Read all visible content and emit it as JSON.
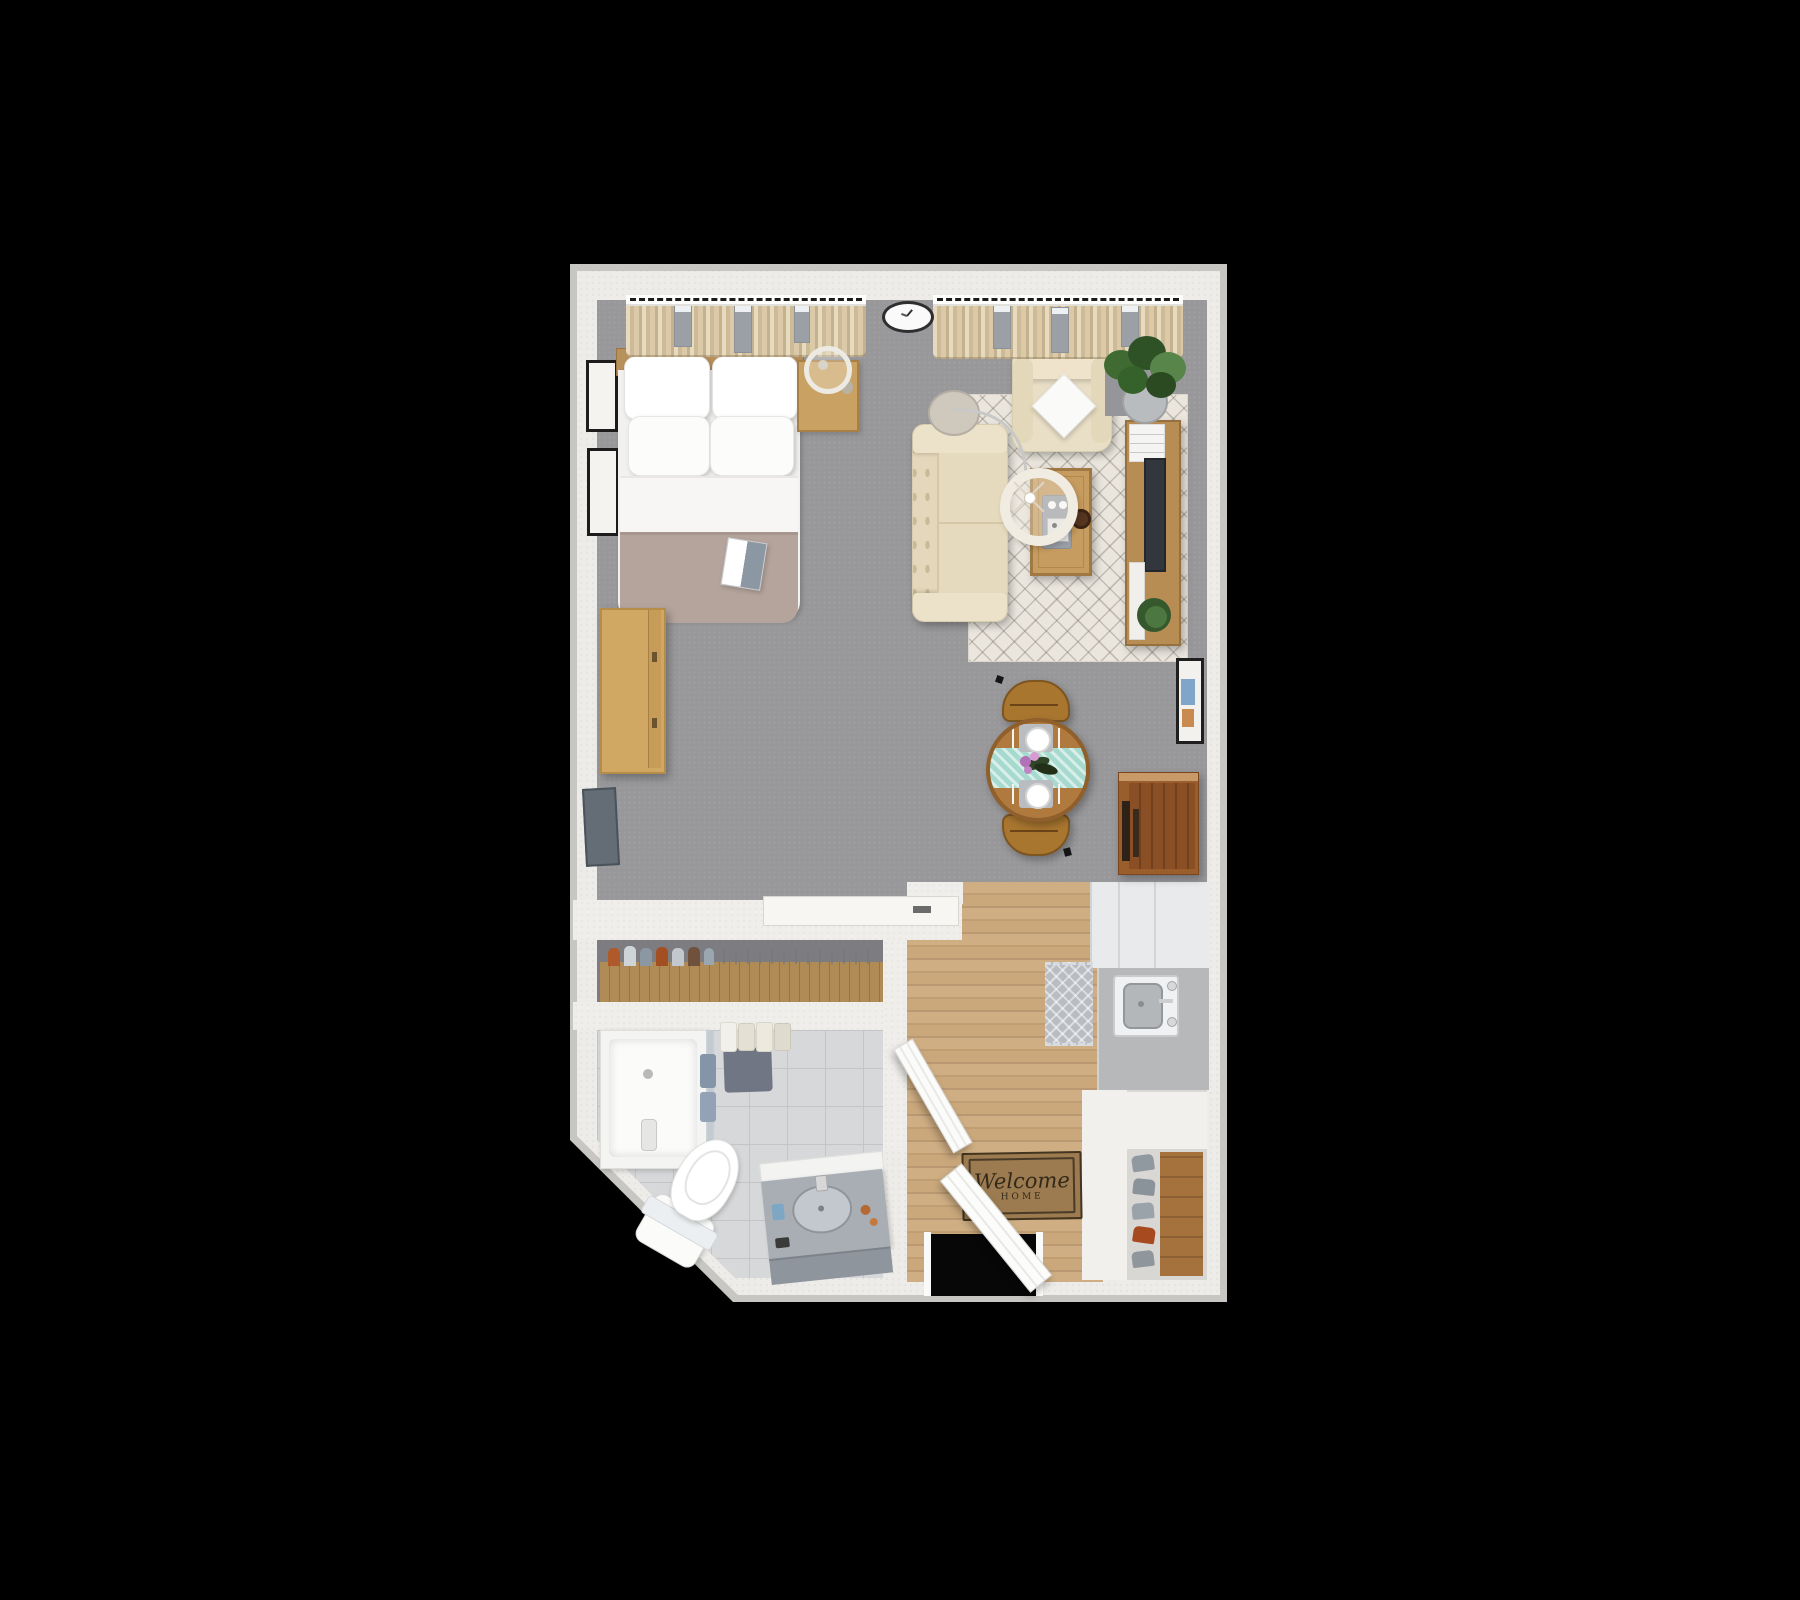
{
  "scene": {
    "type": "3d-floor-plan-top-view",
    "description": "Studio apartment furnished floor plan rendering on black background",
    "background": "#000000"
  },
  "welcome_mat": {
    "line1": "Welcome",
    "line2": "HOME"
  },
  "rooms": [
    {
      "name": "living-sleeping-area",
      "floor": "gray-carpet"
    },
    {
      "name": "kitchen-entry",
      "floor": "wood-plank"
    },
    {
      "name": "walk-through-closet",
      "floor": "dark-gray"
    },
    {
      "name": "bathroom",
      "floor": "light-gray-tile"
    }
  ],
  "furniture": [
    "double-bed-with-pillows",
    "nightstand-with-lamp",
    "wall-art-frames",
    "wall-clock",
    "curtained-windows",
    "floor-arc-lamp",
    "sofa",
    "armchair-with-pillow",
    "potted-plant",
    "area-rug",
    "coffee-table-with-tray",
    "tv-console-with-tv",
    "wall-mounted-tv",
    "dresser",
    "round-dining-table-for-two",
    "dining-chairs",
    "bar-cabinet",
    "kitchen-counter-with-sink",
    "refrigerator",
    "kitchen-island",
    "kitchen-mat",
    "closet-wardrobe-with-clothes",
    "shower",
    "toilet",
    "vanity-with-sink",
    "bath-mat",
    "towels",
    "welcome-mat",
    "entry-door-open",
    "bathroom-door-open",
    "shoe-rack-with-shoes",
    "art-frame-right-wall"
  ],
  "palette": {
    "wall": "#eeece8",
    "outer_edge": "#c7c6c3",
    "living_floor": "#98989b",
    "wood_floor": "#c9a87c",
    "tile_floor": "#d7d8da",
    "closet_floor": "#7d7d81",
    "duvet": "#b4a49c",
    "sofa_cream": "#e9dec6",
    "curtain": "#d8c6a3",
    "table_wood": "#b07a3e",
    "runner_teal": "#a7dacf",
    "mat_brown": "#9b7b4f",
    "counter_gray": "#b6b8ba",
    "cabinet_wood": "#9a5d2c"
  }
}
